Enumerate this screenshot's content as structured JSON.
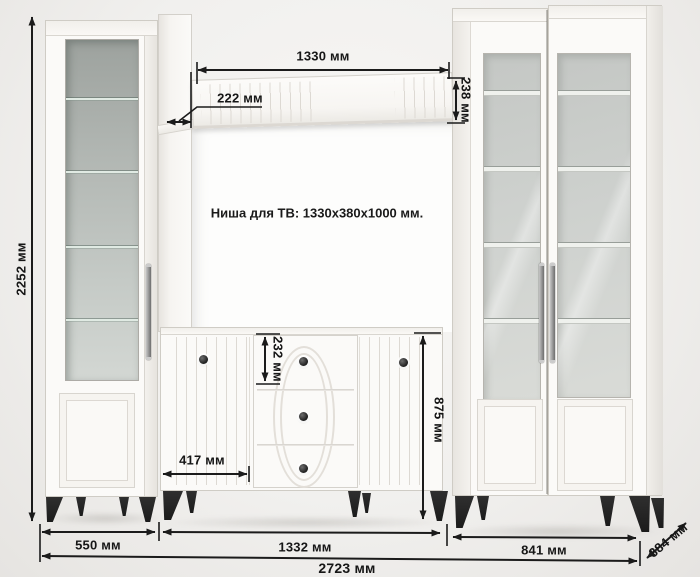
{
  "diagram": {
    "niche_label": "Ниша для ТВ: 1330x380x1000 мм.",
    "units": "мм"
  },
  "dims": {
    "total_height": "2252 мм",
    "shelf_length": "1330 мм",
    "shelf_depth": "222 мм",
    "shelf_face_height": "238 мм",
    "top_drawer_height": "232 мм",
    "commode_door_width": "417 мм",
    "commode_height": "875 мм",
    "left_cabinet_width": "550 мм",
    "tv_stand_width": "1332 мм",
    "right_cabinets_width": "841 мм",
    "total_width": "2723 мм",
    "depth": "384 мм"
  },
  "colors": {
    "background": "#f1f0ee",
    "furniture_white": "#fbfaf8",
    "glass_tinted": "#b2b7b3",
    "glass_light": "#d2d5d2",
    "legs_black": "#262626",
    "dimension_lines": "#1b1b1b"
  }
}
